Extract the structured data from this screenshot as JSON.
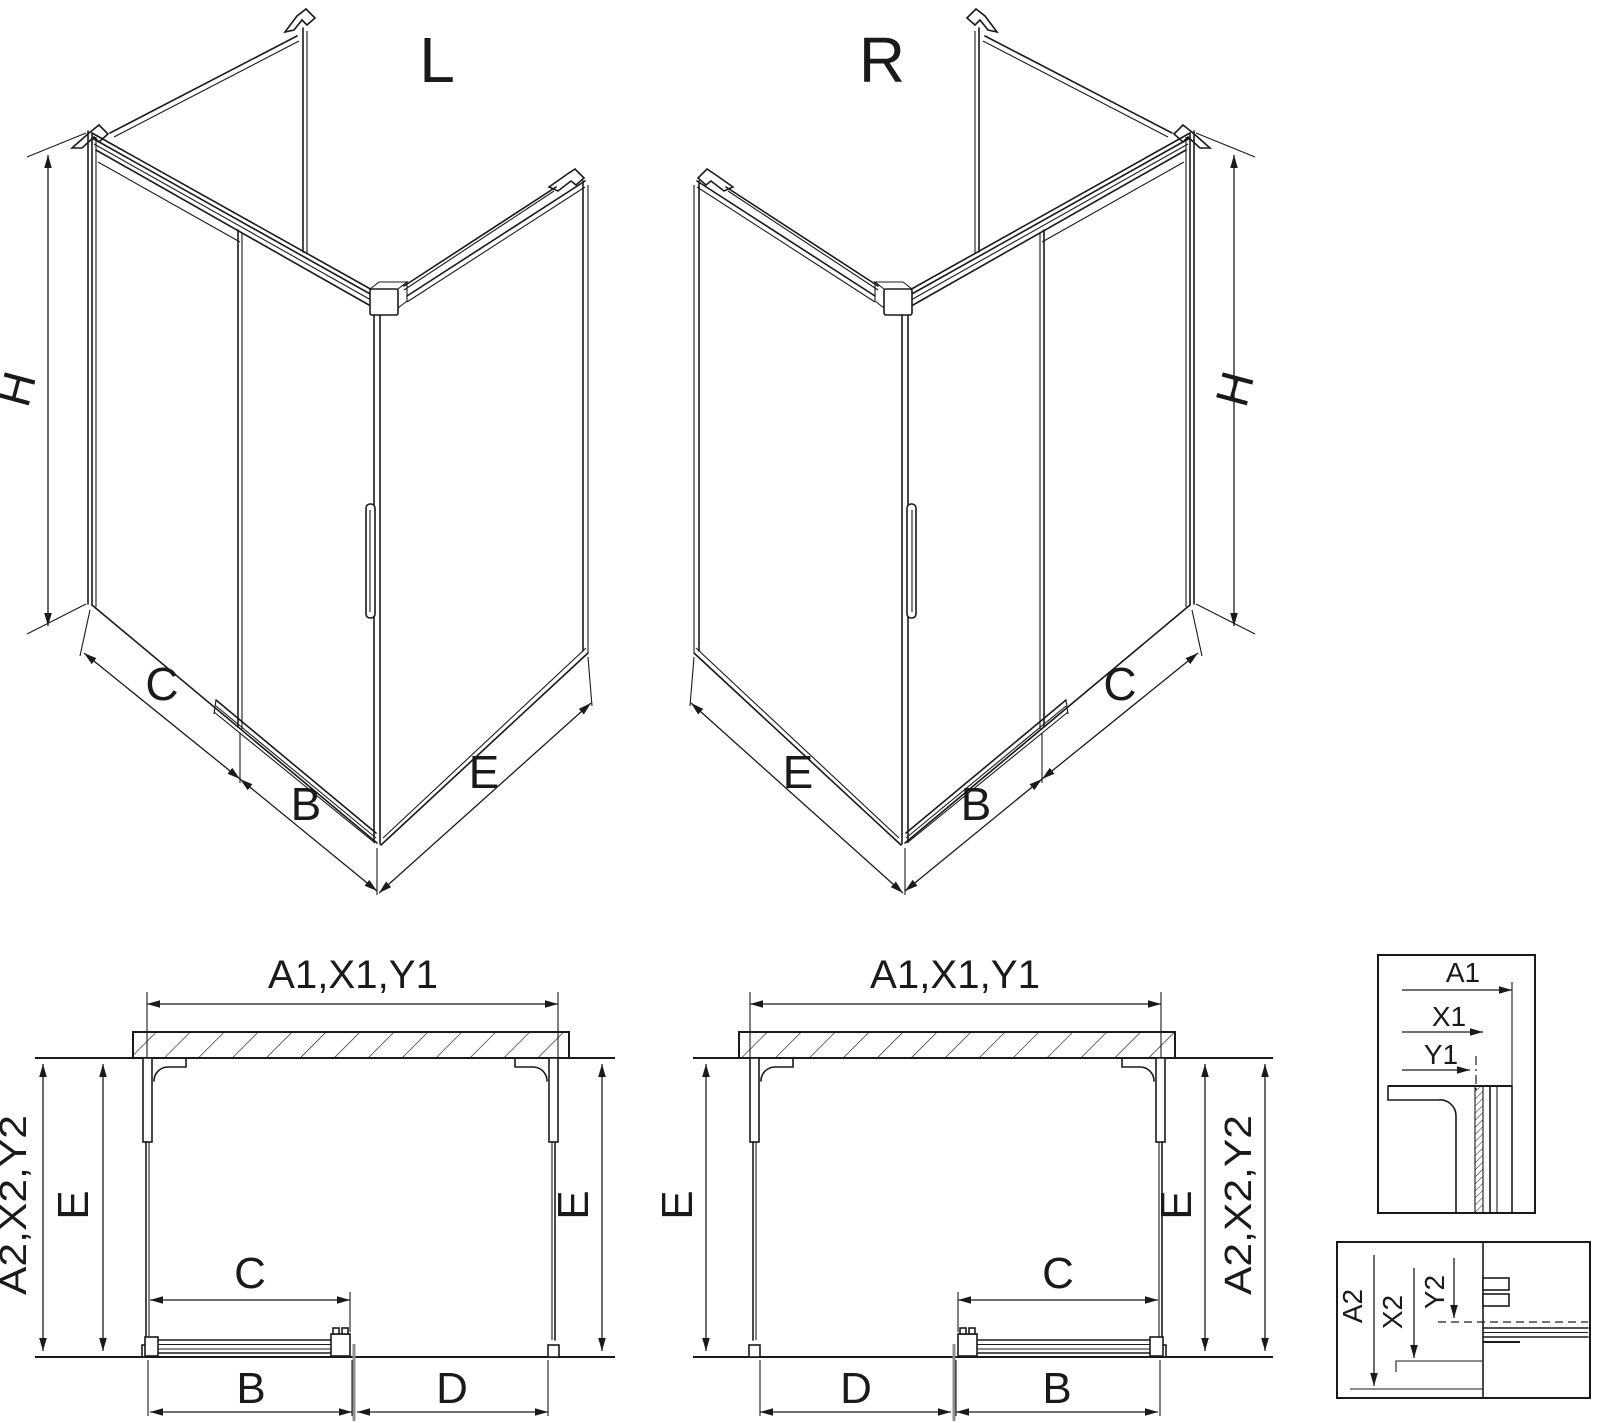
{
  "colors": {
    "line": "#1a1a1a",
    "door_section_line": "#8f8f8f",
    "background": "#ffffff"
  },
  "iso_left": {
    "title": "L",
    "height_label": "H",
    "bottom_labels": {
      "c": "C",
      "b": "B",
      "e": "E"
    }
  },
  "iso_right": {
    "title": "R",
    "height_label": "H",
    "bottom_labels": {
      "c": "C",
      "b": "B",
      "e": "E"
    }
  },
  "plan_left": {
    "top_label": "A1,X1,Y1",
    "side_label": "A2,X2,Y2",
    "e_left": "E",
    "e_right": "E",
    "c": "C",
    "b": "B",
    "d": "D"
  },
  "plan_right": {
    "top_label": "A1,X1,Y1",
    "side_label": "A2,X2,Y2",
    "e_left": "E",
    "e_right": "E",
    "c": "C",
    "b": "B",
    "d": "D"
  },
  "detail_top": {
    "a1": "A1",
    "x1": "X1",
    "y1": "Y1"
  },
  "detail_bottom": {
    "a2": "A2",
    "x2": "X2",
    "y2": "Y2"
  }
}
